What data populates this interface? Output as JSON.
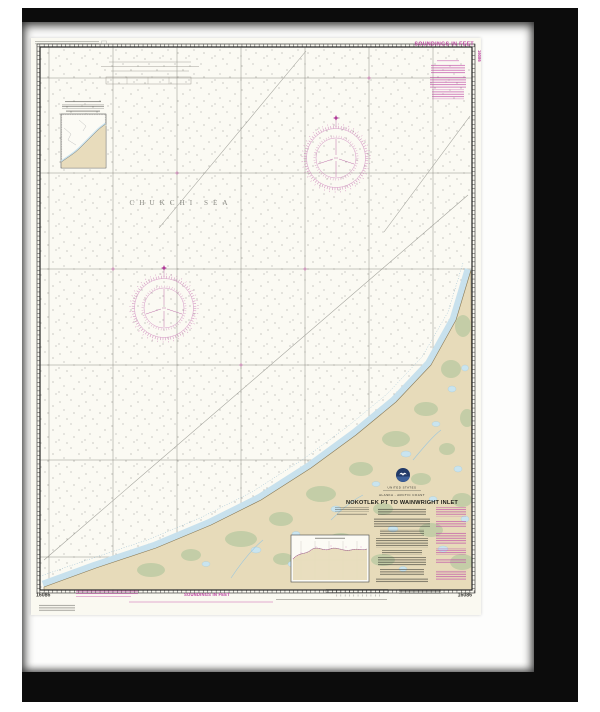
{
  "artwork": {
    "kind": "framed nautical chart print",
    "frame_color": "#0c0c0c",
    "matte_color": "#fdfdfc"
  },
  "chart": {
    "number": "16086",
    "soundings_note": "SOUNDINGS IN FEET",
    "sea_label": "CHUKCHI SEA",
    "title_block": {
      "country": "UNITED STATES",
      "region": "ALASKA - ARCTIC COAST",
      "title": "NOKOTLEK PT TO WAINWRIGHT INLET"
    },
    "icons": {
      "noaa_logo": "noaa-logo",
      "compass_rose": "compass-rose-icon",
      "north_star": "north-star-icon"
    },
    "colors": {
      "paper": "#faf9f1",
      "magenta": "#bc3f9f",
      "land_tan": "#e7dbba",
      "vegetation_green": "#c2cda6",
      "shallow_water_blue": "#c8e1ed",
      "neatline_black": "#222222"
    }
  }
}
